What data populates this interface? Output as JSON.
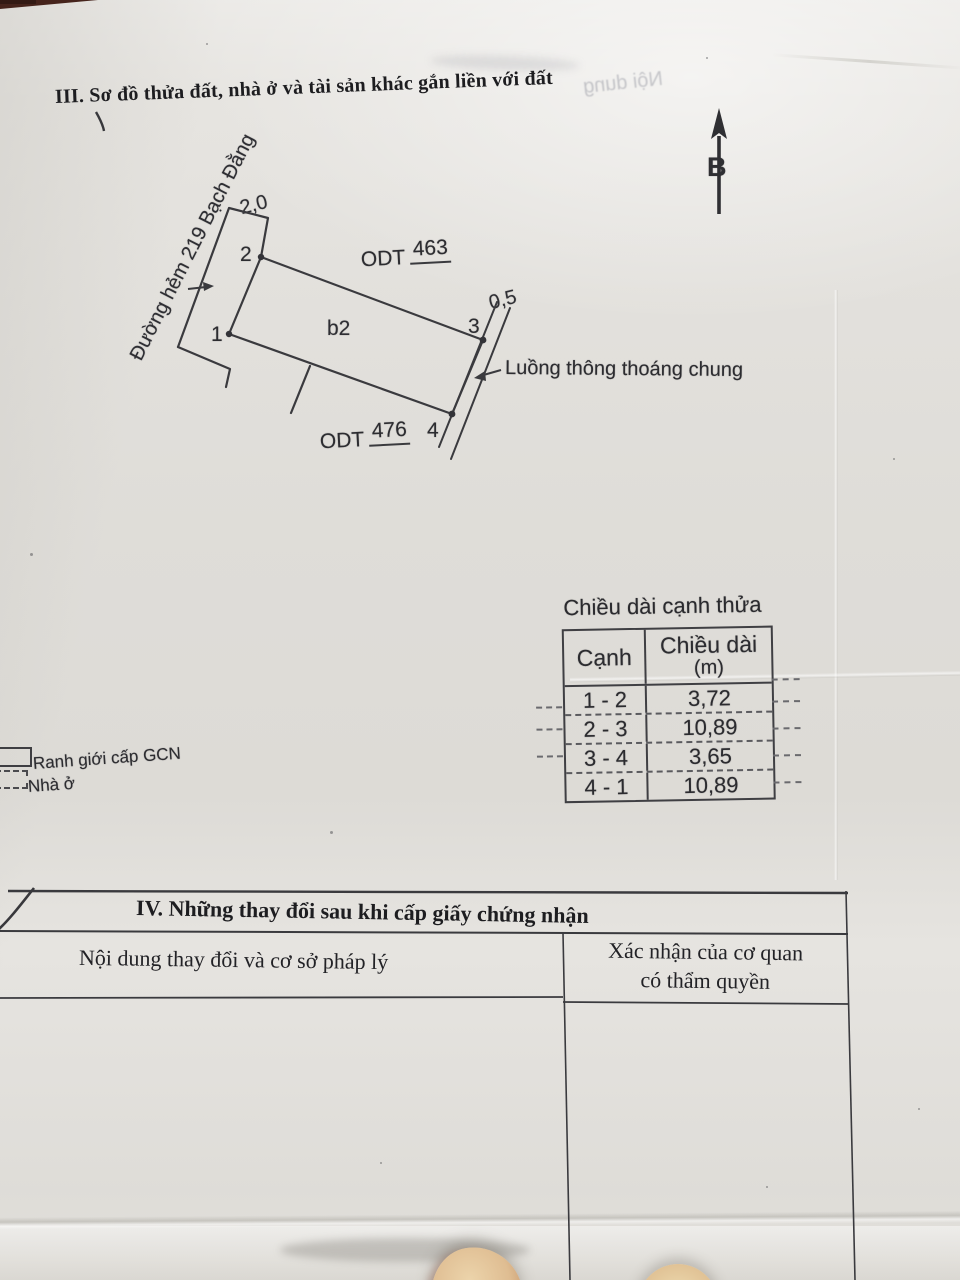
{
  "document": {
    "section3_title": "III. Sơ đồ thửa đất, nhà ở và tài sản khác gắn liền với đất",
    "section4": {
      "title": "IV. Những thay đổi sau khi cấp giấy chứng nhận",
      "col1_header": "Nội dung thay đổi và cơ sở pháp lý",
      "col2_header_line1": "Xác nhận của cơ quan",
      "col2_header_line2": "có thẩm quyền"
    }
  },
  "diagram": {
    "north_label": "B",
    "road_label": "Đường hẻm 219 Bạch Đằng",
    "parcel_label": "b2",
    "neighbor_top_code": "ODT",
    "neighbor_top_number": "463",
    "neighbor_bottom_code": "ODT",
    "neighbor_bottom_number": "476",
    "dim_top": "2,0",
    "dim_right": "0,5",
    "vertex_1": "1",
    "vertex_2": "2",
    "vertex_3": "3",
    "vertex_4": "4",
    "strip_label": "Luồng thông thoáng chung"
  },
  "legend": {
    "boundary_label": "Ranh giới cấp GCN",
    "house_label": "Nhà ở"
  },
  "edge_table": {
    "title": "Chiều dài cạnh thửa",
    "col_edge": "Cạnh",
    "col_length_line1": "Chiều dài",
    "col_length_line2": "(m)",
    "rows": [
      {
        "edge": "1 - 2",
        "length": "3,72"
      },
      {
        "edge": "2 - 3",
        "length": "10,89"
      },
      {
        "edge": "3 - 4",
        "length": "3,65"
      },
      {
        "edge": "4 - 1",
        "length": "10,89"
      }
    ]
  },
  "bleed_through": {
    "text1": "Nội dung"
  },
  "colors": {
    "ink": "#3a3a3e",
    "paper": "#e6e4e0",
    "corner": "#46241c"
  }
}
